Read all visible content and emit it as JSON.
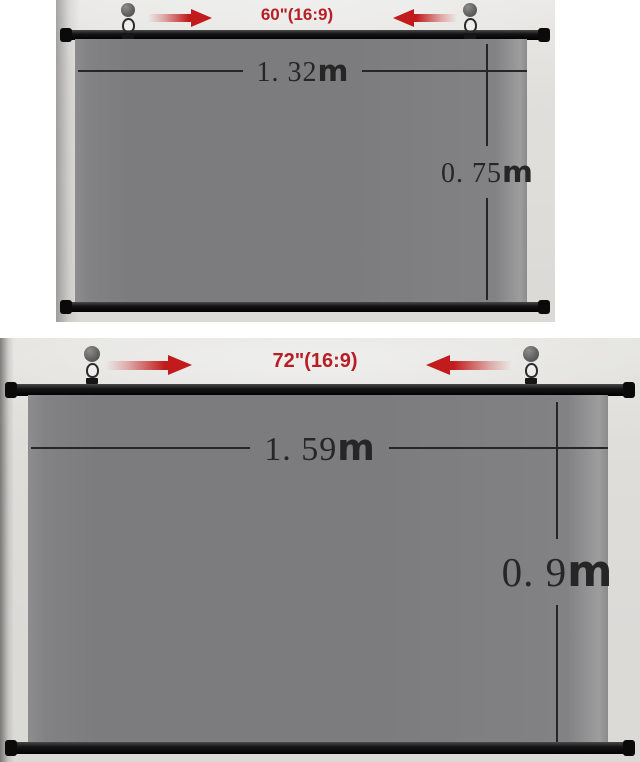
{
  "colors": {
    "accent_red": "#c11b1b",
    "label_red": "#b71f24",
    "screen_gray": "#7c7c7e",
    "rod_black": "#121212",
    "wall_gray": "#e8e6e3",
    "dim_ink": "#262626"
  },
  "screens": [
    {
      "size_label": "60\"(16:9)",
      "width_value": "1. 32",
      "width_unit": "m",
      "height_value": "0. 75",
      "height_unit": "m"
    },
    {
      "size_label": "72\"(16:9)",
      "width_value": "1. 59",
      "width_unit": "m",
      "height_value": "0. 9",
      "height_unit": "m"
    }
  ]
}
